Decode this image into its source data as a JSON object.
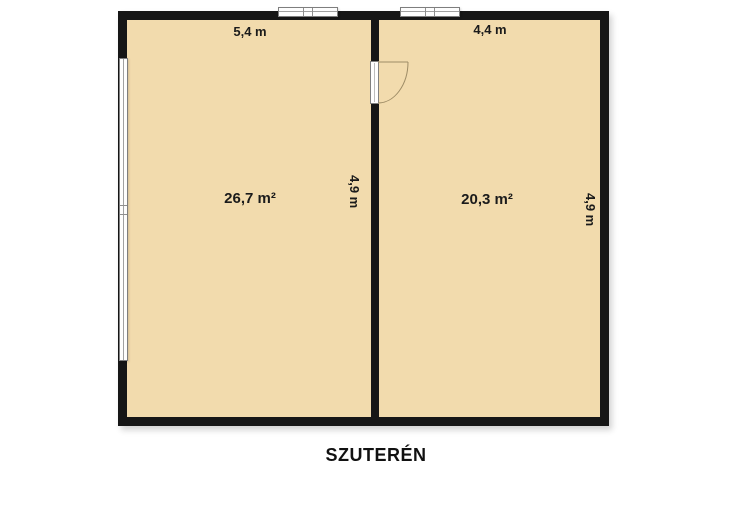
{
  "plan": {
    "title": "SZUTERÉN",
    "rooms": [
      {
        "name": "left-room",
        "area": "26,7 m²",
        "top_dim": "5,4 m",
        "side_dim": "4,9 m"
      },
      {
        "name": "right-room",
        "area": "20,3 m²",
        "top_dim": "4,4 m",
        "side_dim": "4,9 m"
      }
    ],
    "symbols": {
      "door": "door-swing-into-right-room",
      "windows": [
        "top-left-window",
        "top-right-window",
        "left-wall-window"
      ]
    },
    "colors": {
      "floor": "#f2dbad",
      "wall": "#161616",
      "window_fill": "#fdfdfd",
      "door_arc": "#9e8c66",
      "text": "#1b1b1b",
      "background": "#ffffff"
    }
  }
}
